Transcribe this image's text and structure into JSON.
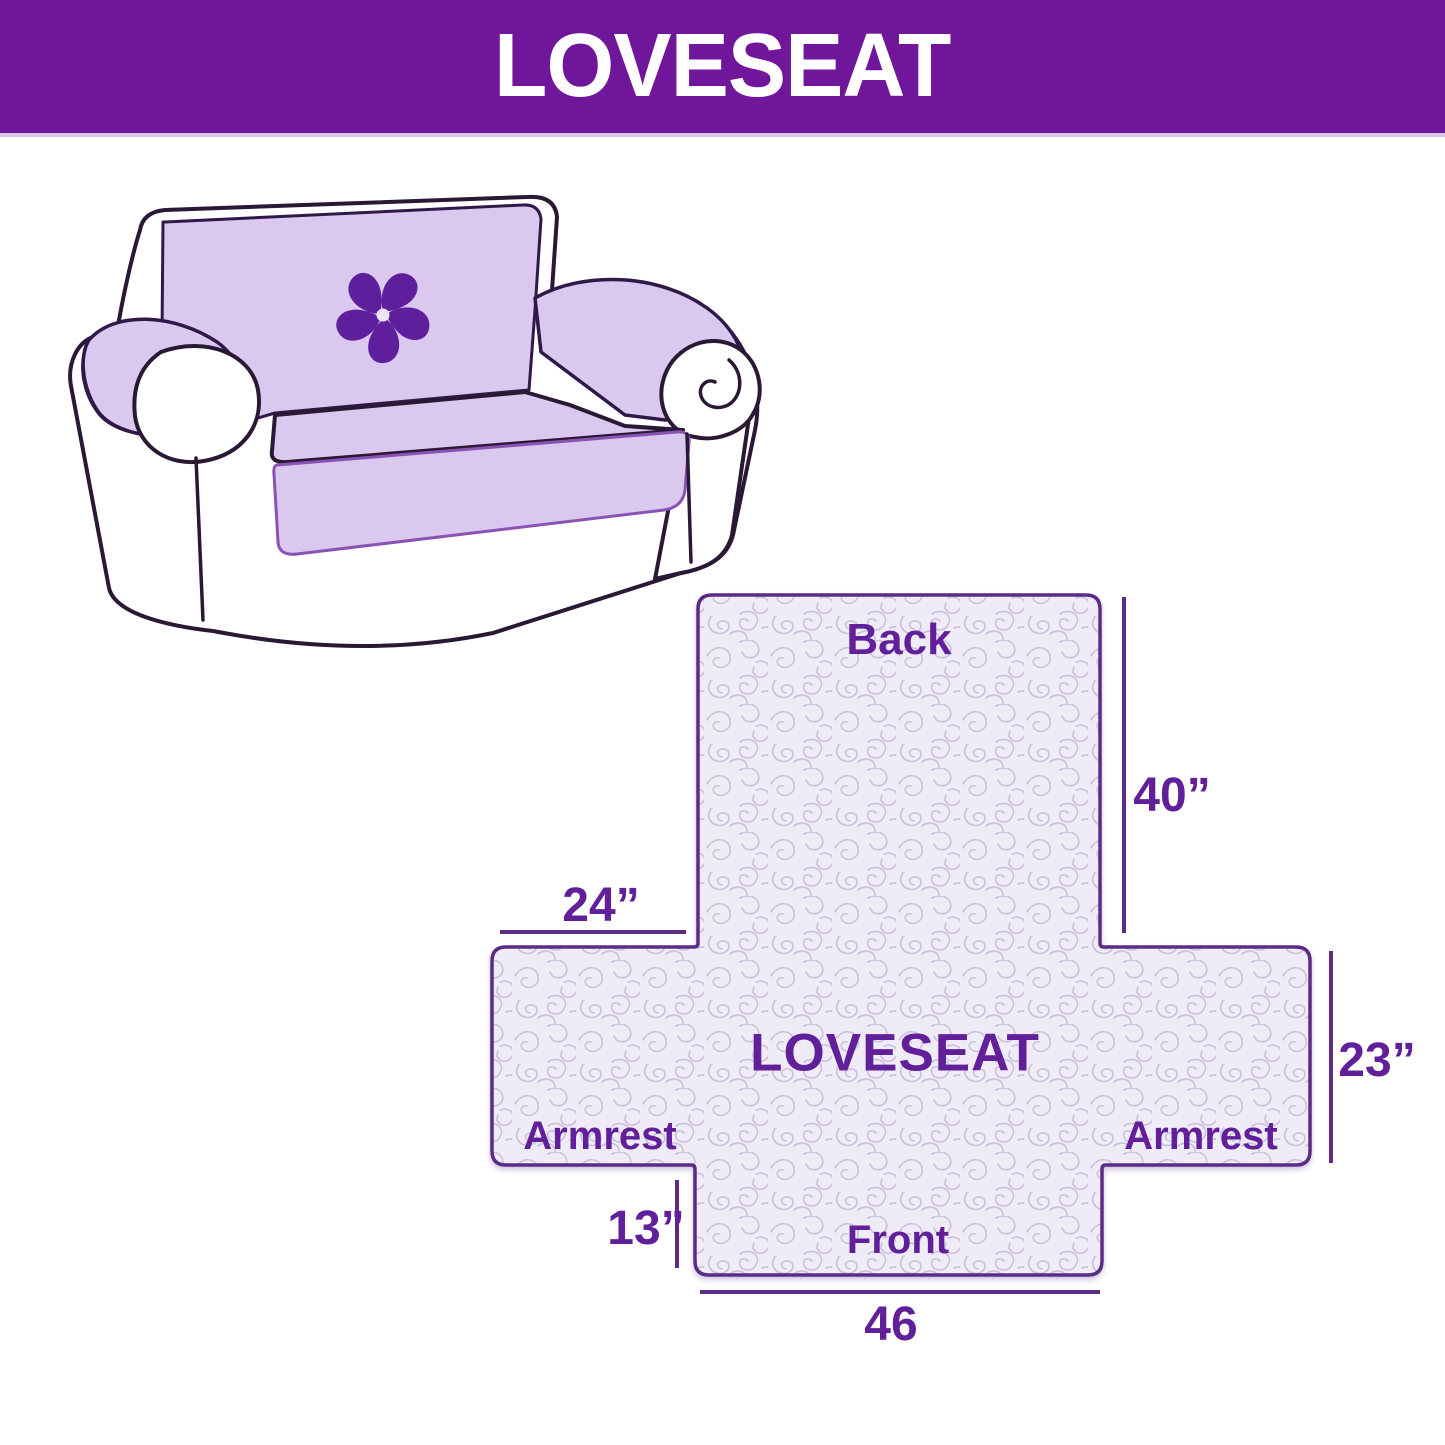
{
  "header": {
    "title": "LOVESEAT"
  },
  "illustration": {
    "description": "loveseat sofa wearing a lavender protective cover",
    "logo": "pinwheel-flower-icon"
  },
  "diagram": {
    "center_label": "LOVESEAT",
    "back_label": "Back",
    "front_label": "Front",
    "armrest_left_label": "Armrest",
    "armrest_right_label": "Armrest",
    "dims": {
      "back_length": "40”",
      "back_width": "24”",
      "side_depth": "23”",
      "front_flap_drop": "13”",
      "front_width": "46"
    }
  },
  "colors": {
    "banner_purple": "#70169B",
    "cover_lavender": "#DBC8EE",
    "outline_dark": "#2A1835",
    "diagram_fill": "#EFEBF7",
    "quilt_pattern": "#CBC0DD",
    "dimension_line": "#5B2C87",
    "label_text": "#611F99",
    "logo_purple": "#5E1F9C"
  }
}
